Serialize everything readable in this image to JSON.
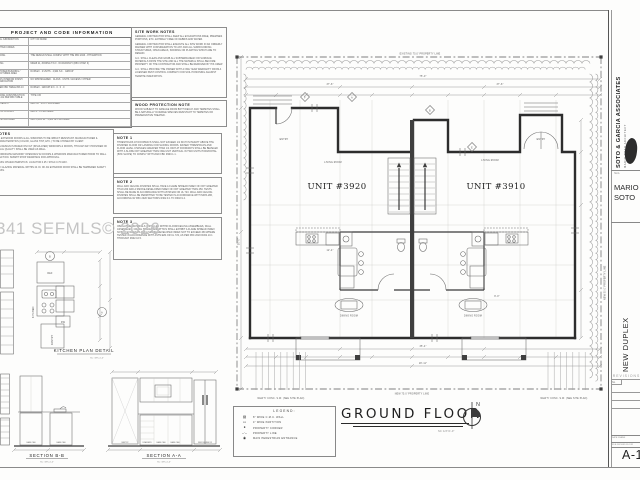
{
  "watermark": "341 SEFMLS© 2026",
  "project_table": {
    "title": "PROJECT AND CODE INFORMATION",
    "rows": [
      {
        "label": "LOCAL JURISDICTION",
        "value": "CITY OF MIAMI"
      },
      {
        "label": "ADOPTED CODES",
        "value": ""
      },
      {
        "label": "BUILDING",
        "value": "THE DESIGN SHALL COMPLY WITH THE FBC 2023 - 8TH EDITION"
      },
      {
        "label": "ZONING",
        "value": "MIAMI 21, ZONING T3-O · OCCUPANCY (FBC CHAP. 3)"
      },
      {
        "label": "PROPOSED BUILDING / STRUCTURES AREA",
        "value": "DUPLEX · 2 UNITS · 4,904 S.F. · GROUP"
      },
      {
        "label": "MEANS INTERIOR FINISH CLASSIFICATION",
        "value": "NO SPRINKLERED · CLASS · UNITS / ACCESS / OTHER"
      },
      {
        "label": "AS PER FBC TABLE 803.13",
        "value": "DUPLEX · GROUP R-3 · 0 · 0 · 0"
      },
      {
        "label": "BUILDING CONSTRUCTION TYPE AS PER FBC TABLE 601",
        "value": "TYPE V-B"
      },
      {
        "label": "MAX HEIGHT",
        "value": "MAX 35' · 25 FT PROVIDED"
      },
      {
        "label": "NUM OF FLOORS",
        "value": "MAX 2 · 2 PROVIDED"
      },
      {
        "label": "MAX SF ALLOWED",
        "value": "MAX 4,904 SF · 4,904 SF PROVIDED"
      }
    ]
  },
  "notes_box": {
    "title": "NOTES",
    "paragraphs": [
      "ALL EXTERIOR DOORS & ALL WINDOWS TO BE IMPACT RESISTANT. MANUFACTURER & CHARACTERISTICS (COLOR, GLASS TINT, ETC.) TO BE CHOSEN BY CLIENT.",
      "THE DESIGN IS BASED ON FGT (INSULATED) WINDOWS & DOORS, THOUGH ANY PROVIDER OF EQUAL QUALITY SHALL BE USED AS WELL.",
      "COORDINATE MASONRY OPENINGS W/ DOORS & WINDOWS MANUFACTURER PRIOR TO WALL ERECTION. SUBMIT SHOP DRAWINGS FOR APPROVAL.",
      "GLASS CHARACTERISTICS: U-FACTOR 0.25 / SHGC 0.70 MAX.",
      "ANY GLAZING MATERIAL WITHIN 24 IN. OF AN EXTERIOR DOOR SHALL BE TEMPERED SAFETY GLASS."
    ]
  },
  "site_work_notes": {
    "title": "SITE WORK NOTES",
    "paragraphs": [
      "GENERAL CONTRACTOR SHALL KEEP ALL EXCAVATIONS FREE, PREMISES PORTIONS, ETC. ENTIRELY FREE OF DEBRIS AND WATER.",
      "GENERAL CONTRACTOR SHALL EXECUTE ALL SITE WORK IN AN ORDERLY MANNER WITH CONSIDERATION TO ANY AND ALL SURROUNDING STRUCTURES, OPEN AREAS, SODDING OR PLANTING WHICH ARE TO REMAIN.",
      "G.C. SHALL CLEAN AND GRUB ALL SUBTERRANEAN OR SURFACE MATERIALS FROM THE SITE AND ALL THE MATERIAL SHALL BECOME PROPERTY OF THE CONTRACTOR AND SHALL BE REMOVED BY HIS CREW.",
      "G.C. SHALL PROVIDE THE OWNER WITH A ONE YEAR WARRANTY FROM A LICENSED PEST CONTROL COMPANY FOR SOIL POISONING AGAINST TERMITE INFESTATION."
    ]
  },
  "wood_note": {
    "title": "WOOD PROTECTION NOTE",
    "paragraphs": [
      "WOOD SUBJECT TO DAMAGE FROM BOTH DECAY AND TERMITES SHALL BE A NATURALLY DURABLE SPECIES RESISTANT TO TERMITES OR PRESERVATIVE TREATED."
    ]
  },
  "note1": {
    "title": "NOTE 1",
    "paragraphs": [
      "THRESHOLDS AT DOORWAYS SHALL NOT EXCEED 1/2 INCH IN HEIGHT ABOVE THE FINISHED FLOOR OR LANDING FOR SLIDING DOORS. RAISED THRESHOLDS AND FLOOR LEVEL CHANGES GREATER THAN 1/4 INCH AT DOORWAYS SHALL BE BEVELED WITH A SLOPE NOT GREATER THAN ONE UNIT VERTICAL IN TWO UNITS HORIZONTAL (50% SLOPE) TO COMPLY WITH 2020 FBC R303.1.1."
    ]
  },
  "note2": {
    "title": "NOTE 2",
    "paragraphs": [
      "WALL AND CEILING FINISHES SHALL HAVE A FLAME SPREAD INDEX OF NOT GREATER THAN 200 AND A SMOKE-DEVELOPED INDEX OF NOT GREATER THAN 450. TESTS SHALL BE MADE IN ACCORDANCE WITH ASTM E84 OR UL 723. WALL AND CEILING FINISHES SHALL BE PERMITTED TO BE TESTED IN ACCORDANCE WITH NFPA 286, ACCORDING W/ FBC 2020 SECTIONS R302.9.1 TO R302.9.4."
    ]
  },
  "note3": {
    "title": "NOTE 3",
    "paragraphs": [
      "INSULATING MATERIALS INSTALLED WITHIN FLOOR/CEILING ASSEMBLIES, WALL ASSEMBLIES, CRAWL SPACES AND ATTICS SHALL EXHIBIT A FLAME SPREAD INDEX NOT TO EXCEED 25 AND A SMOKE-DEVELOPED INDEX NOT TO EXCEED 450 WHERE TESTED IN ACCORDANCE WITH ASTM E84 OR UL 723, AS PER FBC 2020 R302.10.1 THROUGH R302.10.5."
    ]
  },
  "kitchen_detail": {
    "title": "KITCHEN PLAN DETAIL",
    "scale": "SC: 3/8\"=1'-0\"",
    "ref": "REF",
    "kitchen": "KITCHEN",
    "pantry": "PANTRY",
    "dw": "DW",
    "tag_a": "A",
    "tag_b": "B"
  },
  "section_bb": {
    "title": "SECTION B-B",
    "scale": "SC: 3/8\"=1'-0\"",
    "labels": [
      "BASE CAB",
      "BASE CAB"
    ]
  },
  "section_aa": {
    "title": "SECTION A-A",
    "scale": "SC: 3/8\"=1'-0\"",
    "labels": [
      "PANTRY",
      "DRAWERS",
      "BASE CAB",
      "BASE CAB",
      "REFRIGERATOR"
    ]
  },
  "plan": {
    "title": "GROUND FLOOR",
    "scale": "SC: 1/4\"=1'-0\"",
    "north": "N",
    "top_property_line": "EXISTING 75.0' PROPERTY LINE",
    "bottom_property_line": "NEW 75.0' PROPERTY LINE",
    "side_property_line": "NEW 50.0' PROPERTY LINE",
    "unit_left": "UNIT #3920",
    "unit_right": "UNIT #3910",
    "living_room": "LIVING ROOM",
    "dining_room": "DINING ROOM",
    "entry": "ENTRY",
    "sidewalk_note": "NEW 5' CONC. S.W. (SEE SITE PLAN)",
    "dims": [
      "75'-0\"",
      "37'-6\"",
      "37'-6\"",
      "35'-4\"",
      "50'-0\"",
      "12'-4\"",
      "9'-0\"",
      "18'-11\""
    ],
    "tags": [
      "A",
      "B",
      "E",
      "F"
    ]
  },
  "legend": {
    "title": "LEGEND:",
    "items": [
      {
        "sym": "▨",
        "label": "8\" WIDE C.M.U. WALL"
      },
      {
        "sym": "▭",
        "label": "4\" WIDE PARTITION"
      },
      {
        "sym": "●",
        "label": "PROPERTY CORNER"
      },
      {
        "sym": "–·–",
        "label": "PROPERTY LINE"
      },
      {
        "sym": "◉",
        "label": "MAIN PEDESTRIAN ENTRANCE"
      }
    ]
  },
  "titleblock": {
    "firm": "SOTO & GARCIA ASSOCIATES",
    "firm_sub": "MARIO SOTO ARCHITECT",
    "seal_label": "SEAL",
    "architect_line1": "MARIO",
    "architect_line2": "SOTO",
    "project": "NEW DUPLEX",
    "revisions_title": "REVISIONS",
    "revisions_no": "No.",
    "date_label": "DATE  DRAWN",
    "drawn_label": "FILE  GROUND FLOOR",
    "sheet": "A-1"
  },
  "colors": {
    "line": "#2d2d2d",
    "paper": "#fdfdfc",
    "watermark": "#c4c4c4"
  }
}
